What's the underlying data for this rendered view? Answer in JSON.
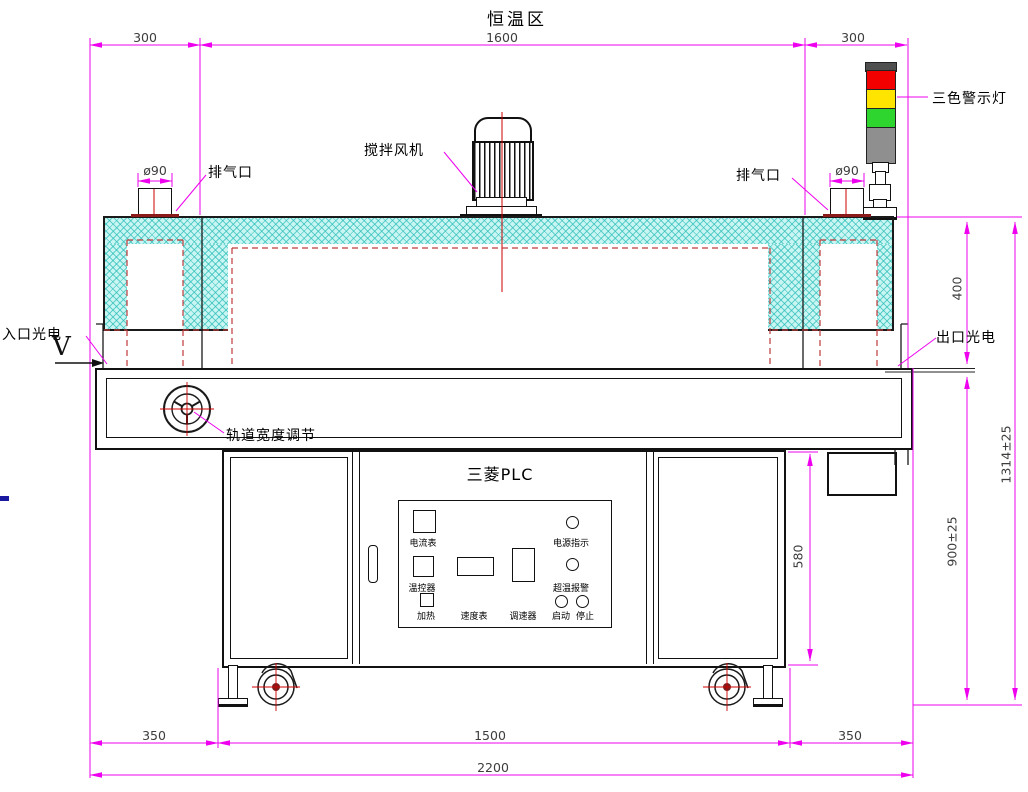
{
  "title": "恒温区",
  "dims": {
    "top": [
      "300",
      "1600",
      "300"
    ],
    "bottom": [
      "350",
      "1500",
      "350"
    ],
    "total_width": "2200",
    "oven_height": "400",
    "table_height": "900±25",
    "overall_height": "1314±25",
    "cabinet_height": "580",
    "port_diameter_left": "ø90",
    "port_diameter_right": "ø90"
  },
  "labels": {
    "exhaust_left": "排气口",
    "exhaust_right": "排气口",
    "stir_fan": "搅拌风机",
    "warning_light": "三色警示灯",
    "inlet_sensor": "入口光电",
    "outlet_sensor": "出口光电",
    "direction": "V",
    "track_adjust": "轨道宽度调节",
    "plc": "三菱PLC"
  },
  "panel": {
    "ammeter": "电流表",
    "power_indicator": "电源指示",
    "temp_controller": "温控器",
    "overtemp_alarm": "超温报警",
    "heating": "加热",
    "speed_meter": "速度表",
    "speed_regulator": "调速器",
    "start": "启动",
    "stop": "停止"
  },
  "colors": {
    "dimension": "#ee00ee",
    "centerline": "#cc0000",
    "dashed_liner": "#bf3a3a",
    "insulation": "#c9f6f3",
    "lamp_red": "#f20000",
    "lamp_yellow": "#ffe400",
    "lamp_green": "#2ed52e",
    "lamp_gray": "#8f8f8f"
  }
}
